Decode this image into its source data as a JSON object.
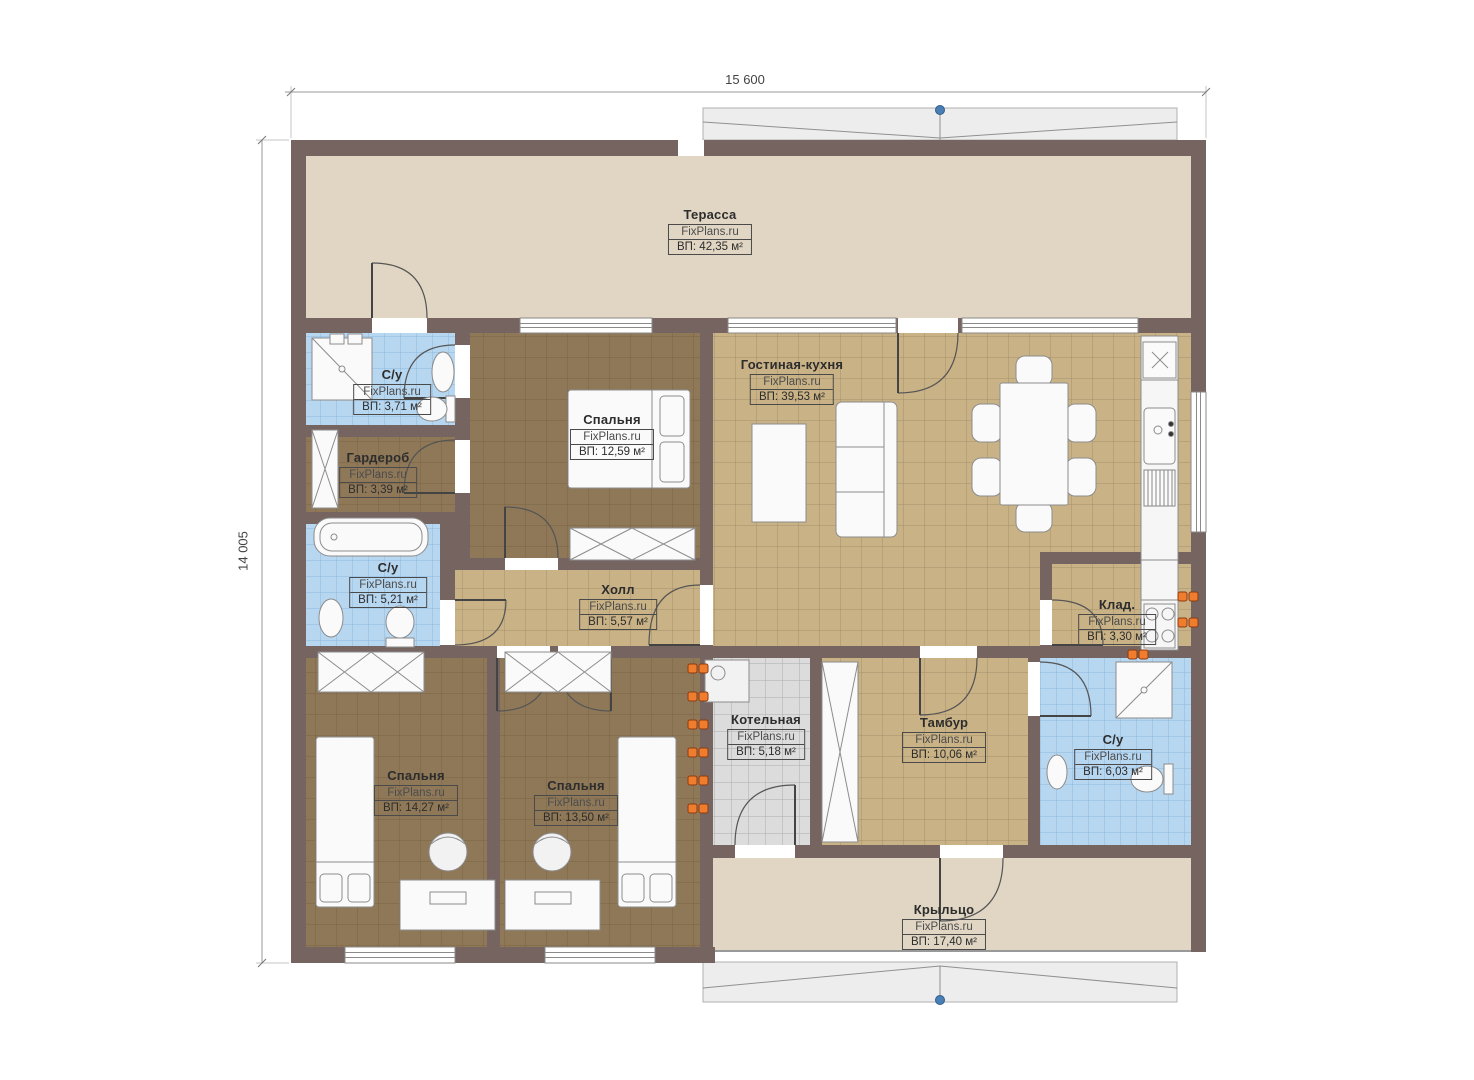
{
  "watermark": "FixPlans.ru",
  "dimensions": {
    "top": "15 600",
    "left": "14 005"
  },
  "rooms": [
    {
      "id": "terrace",
      "name": "Терасса",
      "area": "ВП: 42,35 м²"
    },
    {
      "id": "wc-top",
      "name": "С/у",
      "area": "ВП: 3,71 м²"
    },
    {
      "id": "wardrobe",
      "name": "Гардероб",
      "area": "ВП: 3,39 м²"
    },
    {
      "id": "bedroom-1",
      "name": "Спальня",
      "area": "ВП: 12,59 м²"
    },
    {
      "id": "living",
      "name": "Гостиная-кухня",
      "area": "ВП: 39,53 м²"
    },
    {
      "id": "wc-left",
      "name": "С/у",
      "area": "ВП: 5,21 м²"
    },
    {
      "id": "hall",
      "name": "Холл",
      "area": "ВП: 5,57 м²"
    },
    {
      "id": "storage",
      "name": "Клад.",
      "area": "ВП: 3,30 м²"
    },
    {
      "id": "boiler",
      "name": "Котельная",
      "area": "ВП: 5,18 м²"
    },
    {
      "id": "tambour",
      "name": "Тамбур",
      "area": "ВП: 10,06 м²"
    },
    {
      "id": "wc-right",
      "name": "С/у",
      "area": "ВП: 6,03 м²"
    },
    {
      "id": "bedroom-2",
      "name": "Спальня",
      "area": "ВП: 14,27 м²"
    },
    {
      "id": "bedroom-3",
      "name": "Спальня",
      "area": "ВП: 13,50 м²"
    },
    {
      "id": "porch",
      "name": "Крыльцо",
      "area": "ВП: 17,40 м²"
    }
  ],
  "colors": {
    "wall": "#75645f",
    "terrace_floor": "#e0d6c3",
    "tile_floor": "#c9b285",
    "bedroom_floor": "#8f7858",
    "bath_floor": "#b7d6f0",
    "boiler_floor": "#dcdcdc",
    "radiator": "#f07c2e",
    "canopy": "#ededed",
    "marker_blue": "#4a7fb5"
  }
}
